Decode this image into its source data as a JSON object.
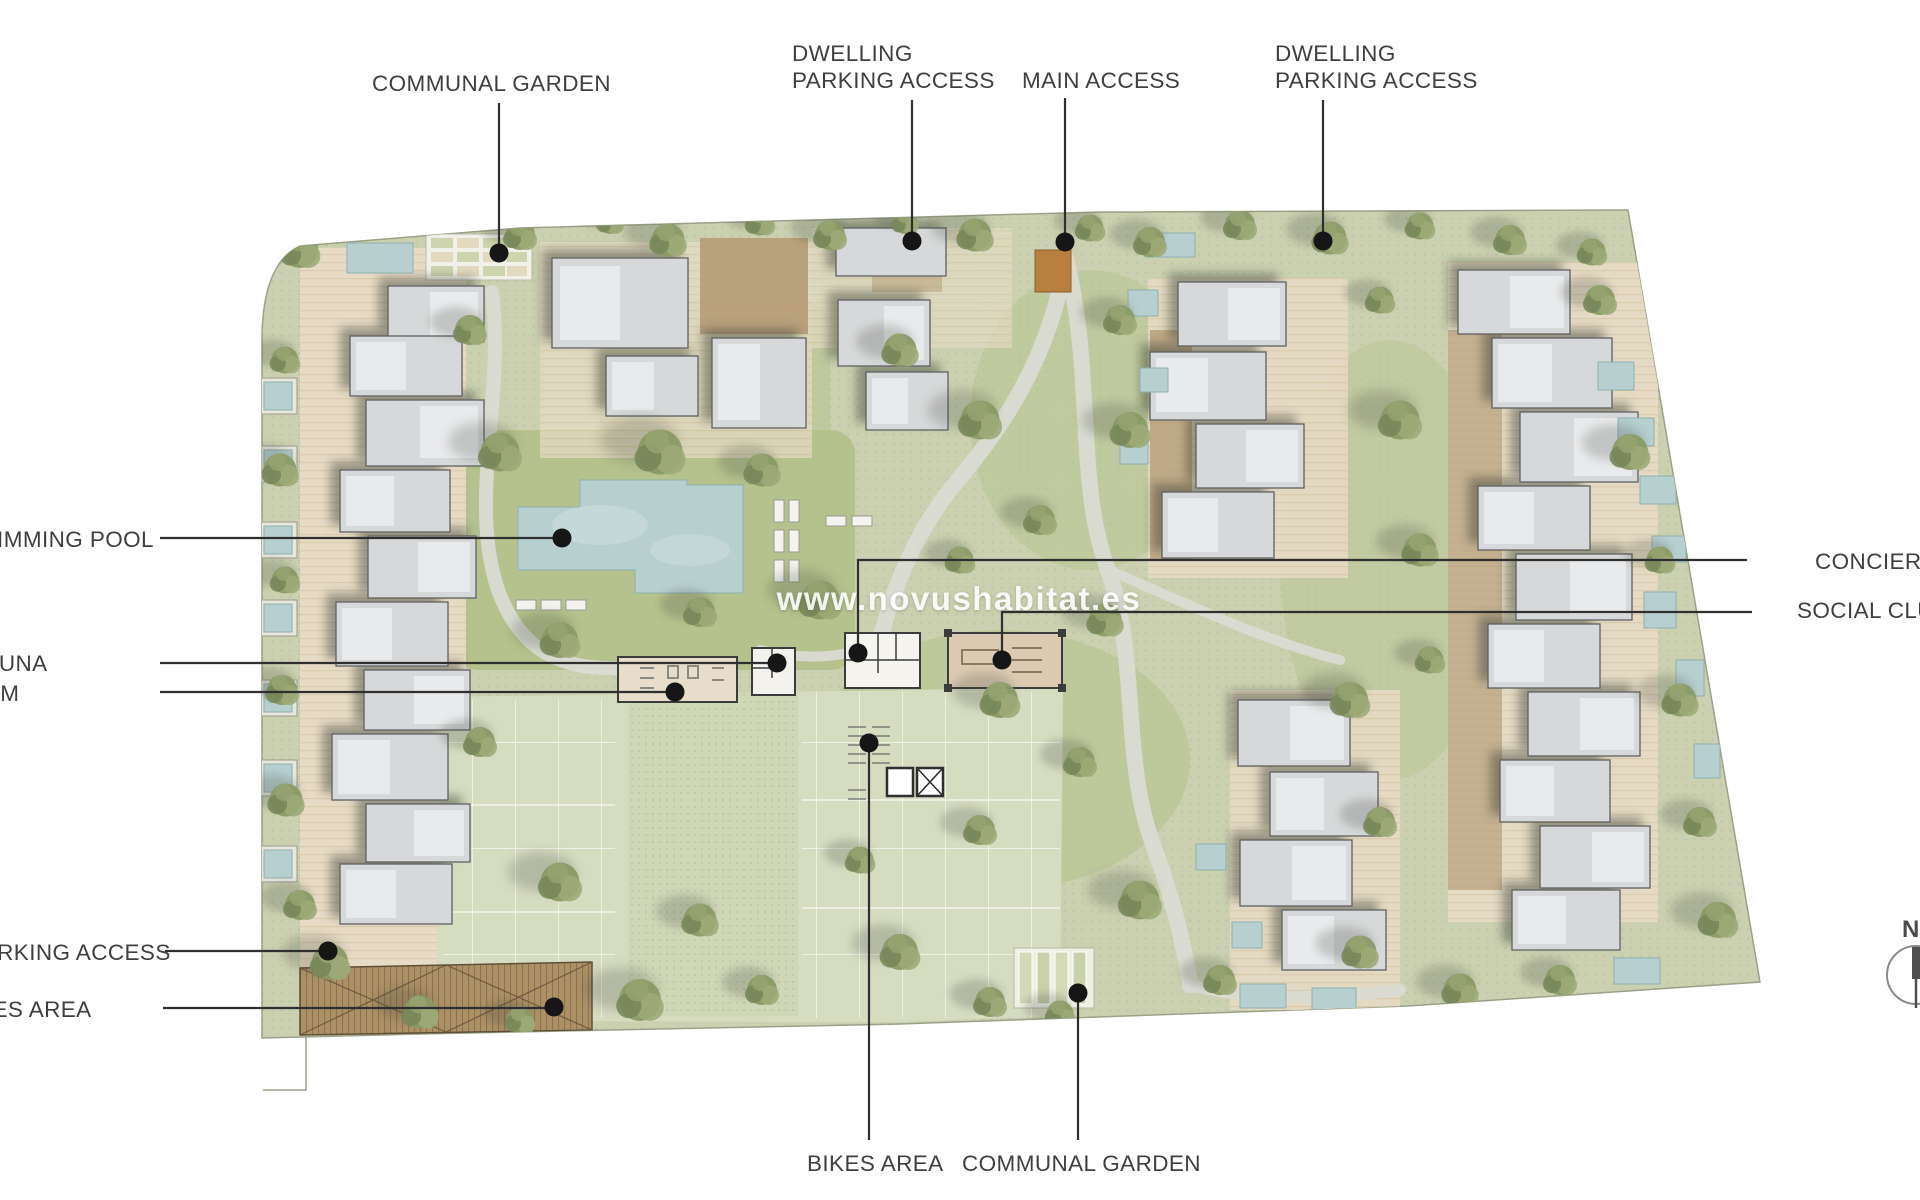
{
  "labels": {
    "communal_garden_top": "COMMUNAL GARDEN",
    "dwelling_parking_access_left": {
      "line1": "DWELLING",
      "line2": "PARKING ACCESS"
    },
    "main_access": "MAIN ACCESS",
    "dwelling_parking_access_right": {
      "line1": "DWELLING",
      "line2": "PARKING ACCESS"
    },
    "swimming_pool": "SWIMMING POOL",
    "sauna": "SAUNA",
    "gym": "GYM",
    "parking_access_left": "PARKING ACCESS",
    "bikes_area_left": "BIKES AREA",
    "concierge": "CONCIERGE",
    "social_club": "SOCIAL CLUB",
    "bikes_area_bottom": "BIKES AREA",
    "communal_garden_bottom": "COMMUNAL GARDEN"
  },
  "watermark": "www.novushabitat.es",
  "compass": {
    "north_label": "N"
  },
  "colors": {
    "ground": "#cbd1b0",
    "lawn": "#b3c18b",
    "pool": "#b7cfcf",
    "building": "#d7d8d9",
    "terrace": "#e8dcc6",
    "mulch": "#b49b76",
    "path": "#dadbd3",
    "access_drive": "#b87f3e",
    "boundary": "#9aa187",
    "leader_line": "#2f2f2f",
    "label_text": "#3f3f3f"
  }
}
